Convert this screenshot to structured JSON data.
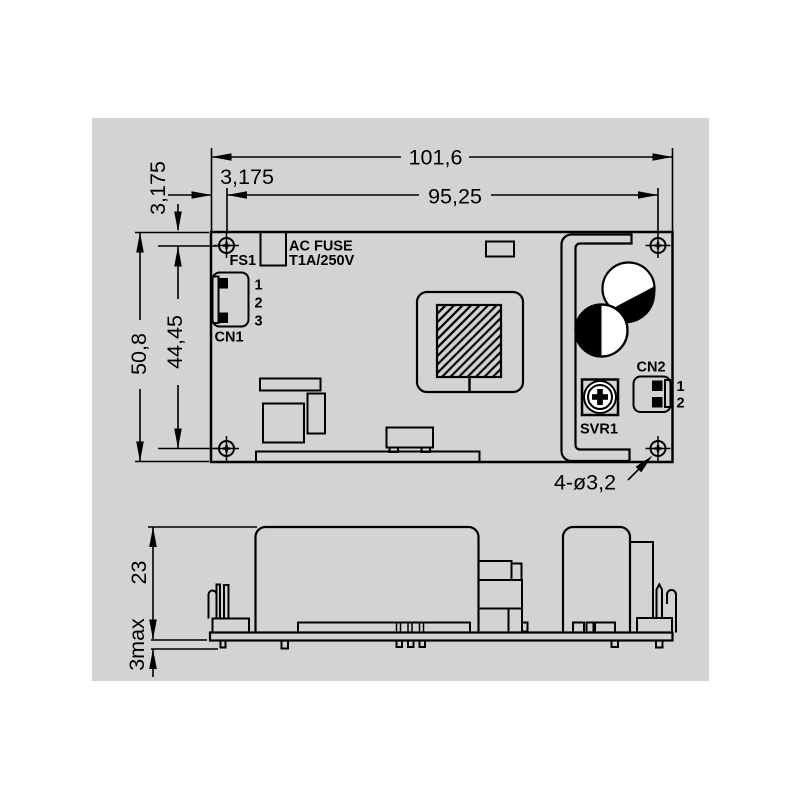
{
  "drawing": {
    "colors": {
      "canvas": "#d3d3d3",
      "line": "#000000",
      "fill_white": "#ffffff"
    },
    "top_view": {
      "dim_width": "101,6",
      "dim_hole_span_h": "95,25",
      "dim_offset_h": "3,175",
      "dim_offset_v": "3,175",
      "dim_height": "50,8",
      "dim_hole_span_v": "44,45",
      "dim_holes_note": "4-ø3,2",
      "fuse_ref": "FS1",
      "fuse_line1": "AC FUSE",
      "fuse_line2": "T1A/250V",
      "cn1_ref": "CN1",
      "cn1_pins": [
        "1",
        "2",
        "3"
      ],
      "cn2_ref": "CN2",
      "cn2_pins": [
        "1",
        "2"
      ],
      "svr_ref": "SVR1"
    },
    "side_view": {
      "dim_component_height": "23",
      "dim_pin_protrusion": "3max"
    }
  }
}
